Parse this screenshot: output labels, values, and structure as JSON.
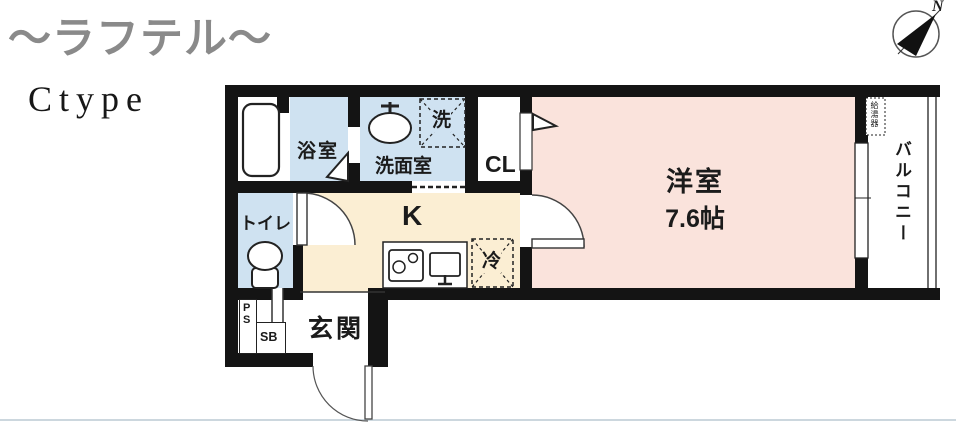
{
  "header": {
    "title": "〜ラフテル〜",
    "type_label": "Ctype"
  },
  "compass": {
    "north_label": "N"
  },
  "rooms": {
    "bathroom": {
      "label": "浴室"
    },
    "washroom": {
      "label": "洗面室"
    },
    "laundry": {
      "label": "洗"
    },
    "closet": {
      "label": "CL"
    },
    "western_room": {
      "label": "洋室",
      "size": "7.6帖"
    },
    "toilet": {
      "label": "トイレ"
    },
    "kitchen": {
      "label": "K"
    },
    "refrigerator": {
      "label": "冷"
    },
    "entrance": {
      "label": "玄関"
    },
    "pipe_space": {
      "label": "PS"
    },
    "shoe_box": {
      "label": "SB"
    },
    "balcony": {
      "label": "バルコニー"
    },
    "water_heater": {
      "label": "給湯器"
    }
  },
  "colors": {
    "wall": "#141414",
    "wet_area_floor": "#cfe2f1",
    "western_room_floor": "#fae3dc",
    "kitchen_floor": "#fbeed3",
    "title_gray": "#8a8a8a"
  }
}
